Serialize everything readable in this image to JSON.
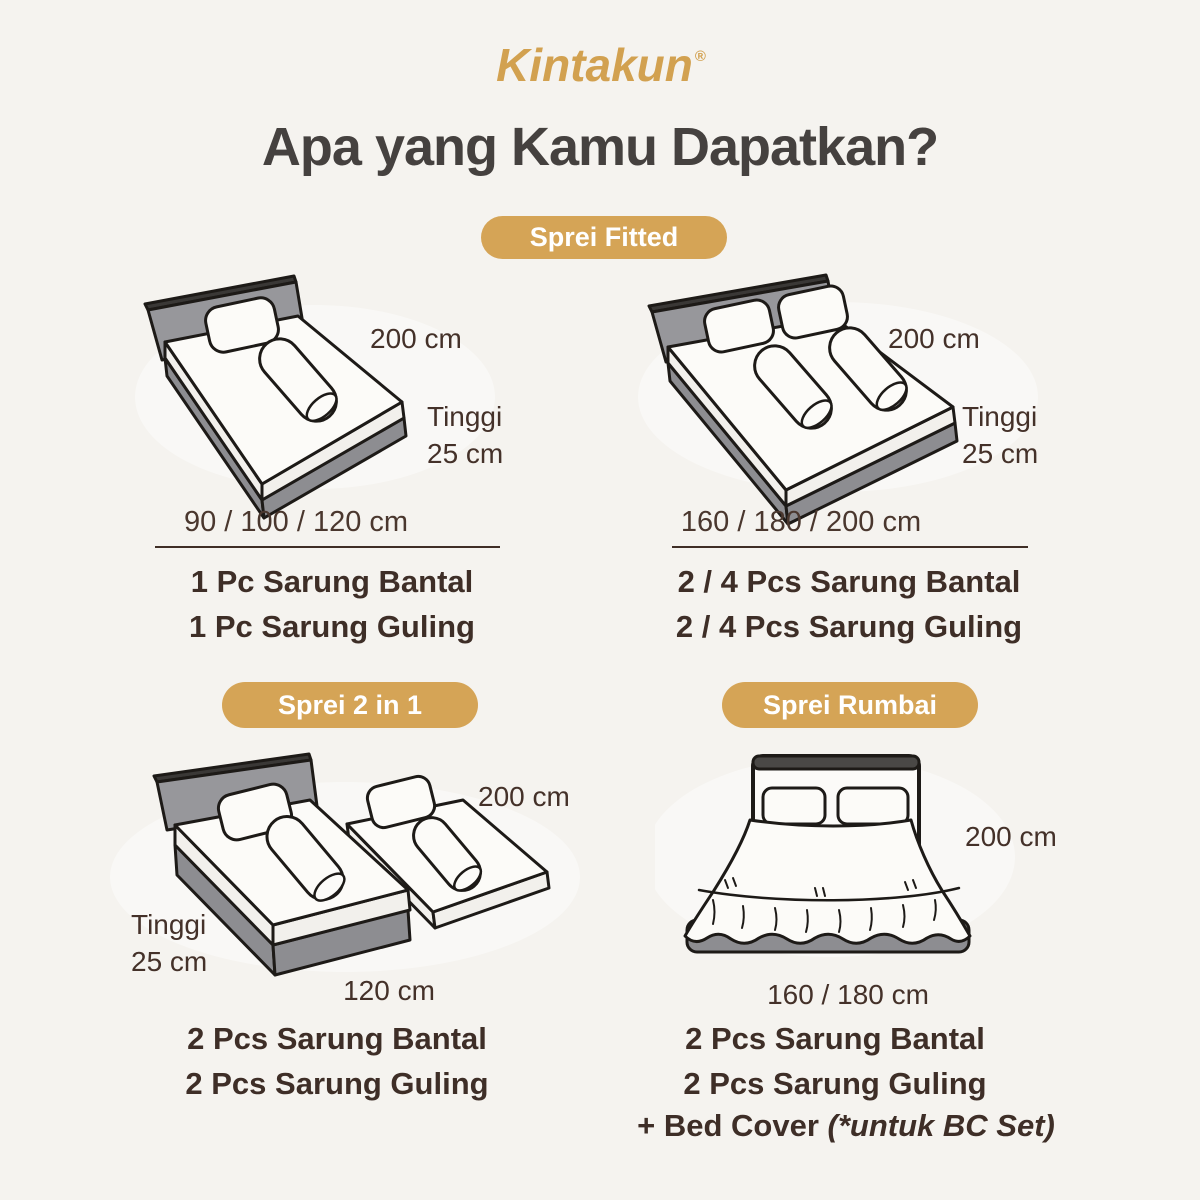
{
  "brand": {
    "logo": "Kintakun",
    "registered_mark": "®"
  },
  "page_title": "Apa yang Kamu Dapatkan?",
  "badges": {
    "fitted": "Sprei Fitted",
    "two_in_one": "Sprei 2 in 1",
    "rumbai": "Sprei Rumbai"
  },
  "colors": {
    "background": "#F5F3EF",
    "gold": "#D5A456",
    "title_text": "#45413F",
    "body_text": "#3E2E27",
    "bed_gray": "#97979B",
    "outline": "#1D1A17",
    "white": "#FFFFFF"
  },
  "fitted_left": {
    "dim_width": "200 cm",
    "dim_height_label": "Tinggi",
    "dim_height_value": "25 cm",
    "sizes": "90 / 100 / 120 cm",
    "item1": "1 Pc Sarung Bantal",
    "item2": "1 Pc Sarung Guling"
  },
  "fitted_right": {
    "dim_width": "200 cm",
    "dim_height_label": "Tinggi",
    "dim_height_value": "25 cm",
    "sizes": "160 / 180 / 200 cm",
    "item1": "2 / 4 Pcs Sarung Bantal",
    "item2": "2 / 4 Pcs Sarung Guling"
  },
  "two_in_one": {
    "dim_width": "200 cm",
    "dim_height_label": "Tinggi",
    "dim_height_value": "25 cm",
    "dim_bed_width": "120 cm",
    "item1": "2 Pcs Sarung Bantal",
    "item2": "2 Pcs Sarung Guling"
  },
  "rumbai": {
    "dim_width": "200 cm",
    "dim_bed_width": "160 / 180 cm",
    "item1": "2 Pcs Sarung Bantal",
    "item2": "2 Pcs Sarung Guling",
    "item3_prefix": "+ Bed Cover ",
    "item3_note": "(*untuk BC Set)"
  }
}
